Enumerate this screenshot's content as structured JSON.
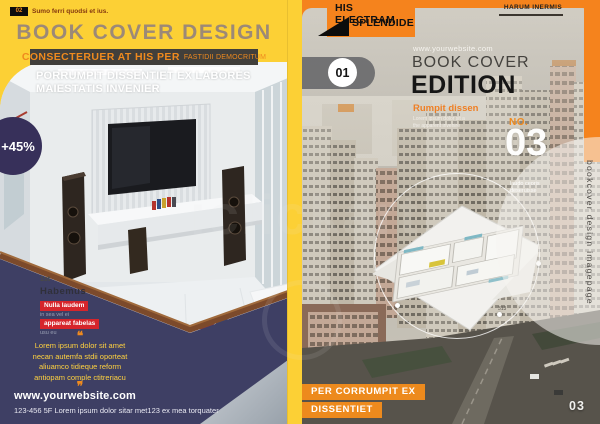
{
  "left_page": {
    "page_tab": {
      "number": "02",
      "caption": "Sumo ferri quodsi et ius."
    },
    "title": "BOOK COVER DESIGN",
    "banner": {
      "main": "CONSECTERUER AT HIS PER",
      "sub": "FASTIDII DEMOCRITUM"
    },
    "subtitle_line1": "PORRUMPIT DISSENTIET EX LABORES",
    "subtitle_line2": "MAIESTATIS INVENIER",
    "discount_badge": "+45%",
    "list": {
      "rank": "1st",
      "heading": "Habemus",
      "tag1": "Nulla laudem",
      "note1": "in sea vel ei",
      "tag2": "appareat fabelas",
      "note2": "usu eu"
    },
    "quote": {
      "open_icon": "❝",
      "lines": [
        "Lorem ipsum dolor sit amet",
        "necan autemfa stdii oporteat",
        "aliuamco tidieque reform",
        "antiopam comple ctitreriacu"
      ],
      "close_icon": "❞"
    },
    "website": "www.yourwebsite.com",
    "address": "123-456 5F Lorem ipsum dolor sitar met123 ex mea torquater"
  },
  "right_page": {
    "ribbon": {
      "line1": "HIS ELECTRAM",
      "line2": "SPLENDIDE"
    },
    "header_tagline": "HARUM INERMIS",
    "chapter_number": "01",
    "website": "www.yourwebsite.com",
    "title_line1": "BOOK COVER",
    "title_line2": "EDITION",
    "subtitle": "Rumpit dissen",
    "subtitle_note1": "Lorem ipsum dolor sit a",
    "subtitle_note2": "the apparent invenire",
    "issue": {
      "label": "NO.",
      "number": "03",
      "note1": "laudo ceoris",
      "note2": "deseruisse"
    },
    "side_text": "bookcover design imagepage",
    "footer_tag1": "PER CORRUMPIT EX",
    "footer_tag2": "DISSENTIET",
    "page_number": "03",
    "photo_signs": {
      "sign1": "313",
      "sign2": "313"
    }
  },
  "watermark": "iclickart",
  "colors": {
    "yellow": "#fcd035",
    "navy": "#3e3f64",
    "purple_badge": "#37305a",
    "orange": "#f5831d",
    "red_tag": "#d6252b",
    "banner_dark": "#413f3b",
    "accent_text": "#ef8a1e"
  }
}
